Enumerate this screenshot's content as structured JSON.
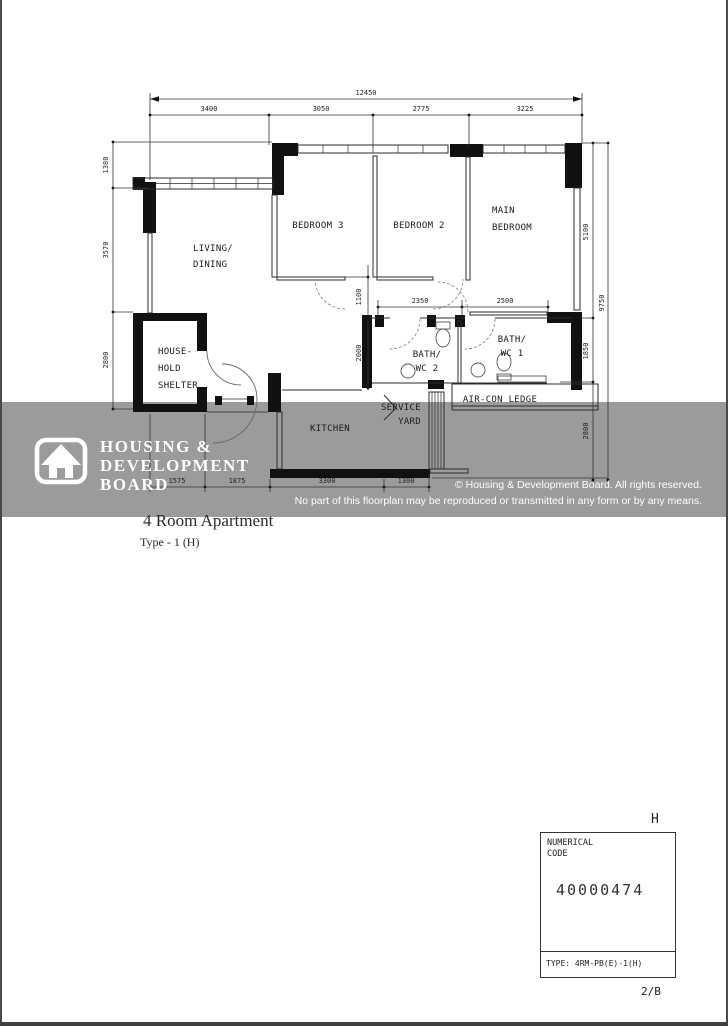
{
  "page": {
    "title": "4 Room Apartment",
    "subtitle": "Type - 1 (H)"
  },
  "watermark": {
    "band_color": "#9b9b9b",
    "logo_lines": [
      "HOUSING &",
      "DEVELOPMENT",
      "BOARD"
    ],
    "copyright_line1": "© Housing & Development Board. All rights reserved.",
    "copyright_line2": "No part of this floorplan may be reproduced or transmitted in any form or by any means."
  },
  "floorplan": {
    "rooms": {
      "living": [
        "LIVING/",
        "DINING"
      ],
      "bedroom3": "BEDROOM 3",
      "bedroom2": "BEDROOM 2",
      "main_bedroom": [
        "MAIN",
        "BEDROOM"
      ],
      "household_shelter": [
        "HOUSE-",
        "HOLD",
        "SHELTER"
      ],
      "kitchen": "KITCHEN",
      "service_yard": [
        "SERVICE",
        "YARD"
      ],
      "bath_wc2": [
        "BATH/",
        "WC 2"
      ],
      "bath_wc1": [
        "BATH/",
        "WC 1"
      ],
      "aircon_ledge": "AIR-CON LEDGE"
    },
    "dims": {
      "top_total": "12450",
      "top_segments": [
        "3400",
        "3050",
        "2775",
        "3225"
      ],
      "left": [
        "1380",
        "3570",
        "2800"
      ],
      "right_segments": [
        "5100",
        "1850",
        "2800"
      ],
      "right_total": "9750",
      "bottom": [
        "1575",
        "1875",
        "3300",
        "1300"
      ],
      "corridor": "1100",
      "bath_depth": "2000",
      "bath2_width": "2350",
      "bath1_width": "2500"
    }
  },
  "title_block": {
    "orientation_letter": "H",
    "numerical_code_label": "NUMERICAL\nCODE",
    "numerical_code": "40000474",
    "type_label": "TYPE: 4RM-PB(E)-1(H)",
    "page_ref": "2/B"
  }
}
